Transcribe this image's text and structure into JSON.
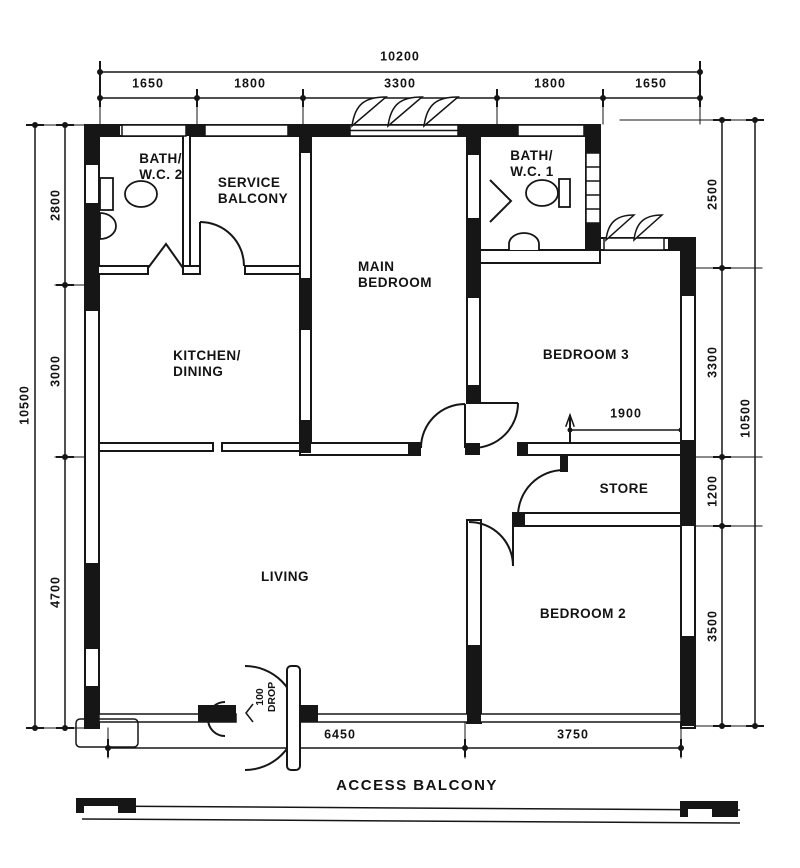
{
  "plan": {
    "rooms": [
      {
        "id": "bath-wc-2",
        "lines": [
          "BATH/",
          "W.C. 2"
        ]
      },
      {
        "id": "service-balcony",
        "lines": [
          "SERVICE",
          "BALCONY"
        ]
      },
      {
        "id": "main-bedroom",
        "lines": [
          "MAIN",
          "BEDROOM"
        ]
      },
      {
        "id": "bath-wc-1",
        "lines": [
          "BATH/",
          "W.C. 1"
        ]
      },
      {
        "id": "kitchen-dining",
        "lines": [
          "KITCHEN/",
          "DINING"
        ]
      },
      {
        "id": "bedroom-3",
        "lines": [
          "BEDROOM 3"
        ]
      },
      {
        "id": "store",
        "lines": [
          "STORE"
        ]
      },
      {
        "id": "living",
        "lines": [
          "LIVING"
        ]
      },
      {
        "id": "bedroom-2",
        "lines": [
          "BEDROOM 2"
        ]
      }
    ],
    "dimensions": {
      "top_overall": "10200",
      "top_segments": [
        "1650",
        "1800",
        "3300",
        "1800",
        "1650"
      ],
      "left_overall": "10500",
      "left_segments": [
        "2800",
        "3000",
        "4700"
      ],
      "right_overall": "10500",
      "right_segments": [
        "2500",
        "3300",
        "1200",
        "3500"
      ],
      "bottom_segments": [
        "6450",
        "3750"
      ],
      "store_clearance": "1900"
    },
    "annotations": {
      "entrance_drop": [
        "100",
        "DROP"
      ],
      "access_balcony": "ACCESS BALCONY"
    },
    "colors": {
      "ink": "#161616",
      "paper": "#ffffff"
    }
  }
}
